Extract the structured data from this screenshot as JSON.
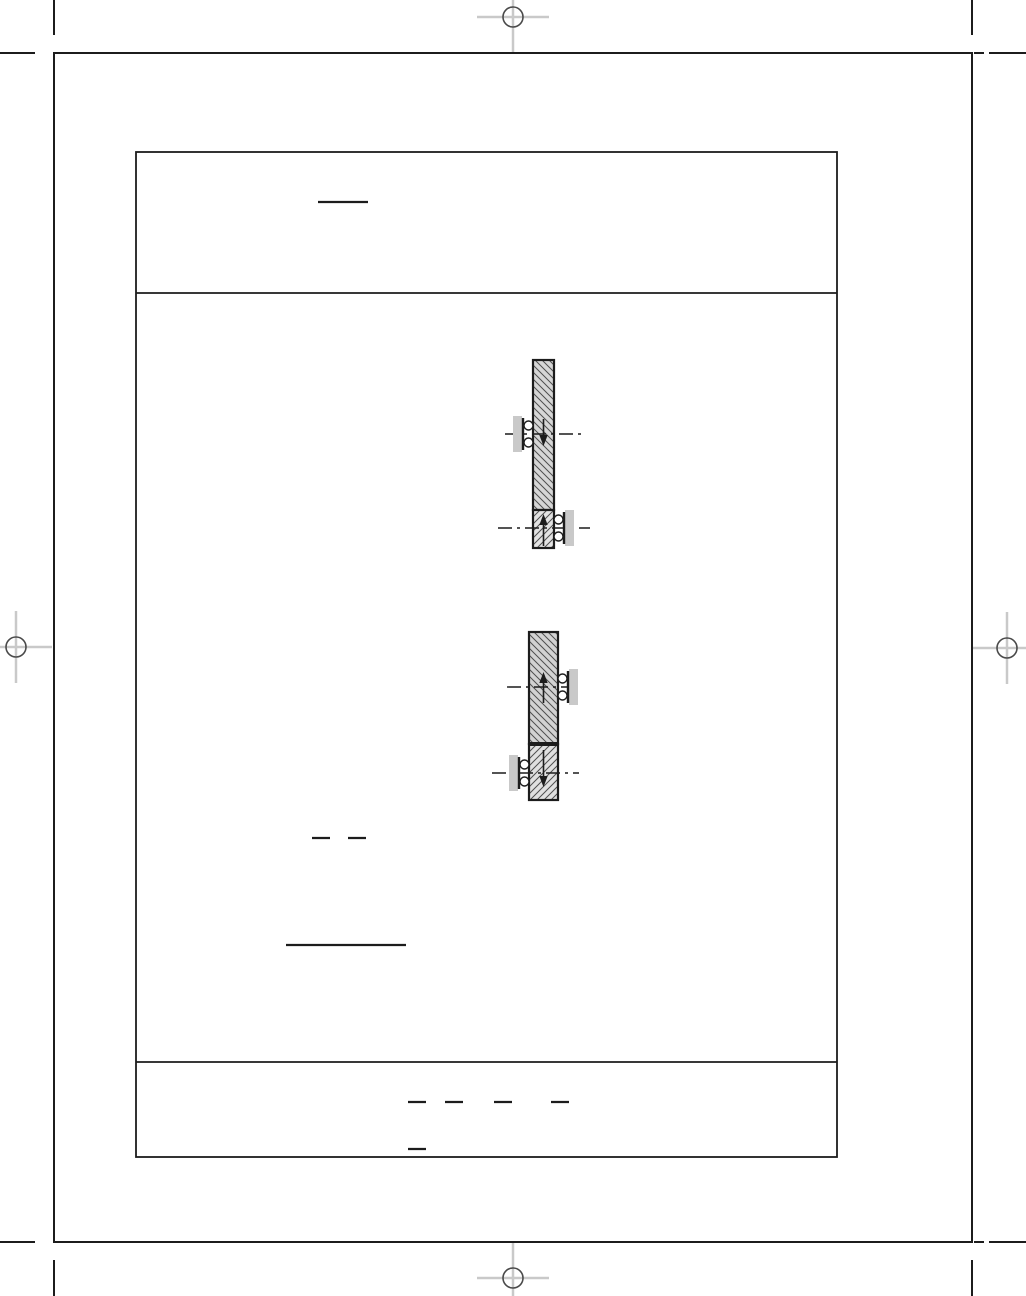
{
  "page": {
    "width": 1026,
    "height": 1296,
    "background": "#ffffff"
  },
  "colors": {
    "line": "#1c1c1c",
    "registration_cross": "#c9c9c9",
    "registration_circle": "#4a4a4a",
    "plate_fill": "#c9c9c9",
    "hatch_line": "#4f4f4f",
    "circle_fill": "#ffffff"
  },
  "frames": {
    "outer": {
      "x": 54,
      "y": 53,
      "w": 918,
      "h": 1189,
      "stroke_w": 2
    },
    "inner": {
      "x": 136,
      "y": 152,
      "w": 701,
      "h": 1005,
      "stroke_w": 1.8
    },
    "divider_y": [
      293,
      1062
    ]
  },
  "registration_marks": [
    {
      "cx": 513,
      "cy": 17,
      "r": 10,
      "arm": 36
    },
    {
      "cx": 16,
      "cy": 647,
      "r": 10,
      "arm": 36
    },
    {
      "cx": 1007,
      "cy": 648,
      "r": 10,
      "arm": 36
    },
    {
      "cx": 513,
      "cy": 1278,
      "r": 10,
      "arm": 36
    }
  ],
  "crop_marks": [
    {
      "x1": 54,
      "y1": 0,
      "x2": 54,
      "y2": 35
    },
    {
      "x1": 0,
      "y1": 53,
      "x2": 35,
      "y2": 53
    },
    {
      "x1": 972,
      "y1": 0,
      "x2": 972,
      "y2": 35
    },
    {
      "x1": 974,
      "y1": 53,
      "x2": 984,
      "y2": 53
    },
    {
      "x1": 989,
      "y1": 53,
      "x2": 1026,
      "y2": 53
    },
    {
      "x1": 54,
      "y1": 1260,
      "x2": 54,
      "y2": 1296
    },
    {
      "x1": 0,
      "y1": 1242,
      "x2": 35,
      "y2": 1242
    },
    {
      "x1": 972,
      "y1": 1260,
      "x2": 972,
      "y2": 1296
    },
    {
      "x1": 974,
      "y1": 1242,
      "x2": 984,
      "y2": 1242
    },
    {
      "x1": 989,
      "y1": 1242,
      "x2": 1026,
      "y2": 1242
    }
  ],
  "rule_lines": [
    {
      "x1": 318,
      "y": 202,
      "x2": 368
    },
    {
      "x1": 312,
      "y": 838,
      "x2": 330
    },
    {
      "x1": 348,
      "y": 838,
      "x2": 366
    },
    {
      "x1": 286,
      "y": 945,
      "x2": 406
    },
    {
      "x1": 408,
      "y": 1102,
      "x2": 426
    },
    {
      "x1": 445,
      "y": 1102,
      "x2": 463
    },
    {
      "x1": 494,
      "y": 1102,
      "x2": 512
    },
    {
      "x1": 551,
      "y": 1102,
      "x2": 569
    },
    {
      "x1": 408,
      "y": 1149,
      "x2": 426
    }
  ],
  "figures": [
    {
      "name": "support-diagram-upper",
      "bar": {
        "x": 533,
        "width": 21,
        "top": 360,
        "junction": 510,
        "bottom": 548
      },
      "junction_stroke": 1.6,
      "top_fill": "#d6d6d6",
      "bottom_fill": "#e3e3e3",
      "bearings": [
        {
          "side": "left",
          "cy": 434,
          "centerline": [
            505,
            584
          ],
          "arrow": {
            "dir": "down",
            "from": 419,
            "to": 446
          }
        },
        {
          "side": "right",
          "cy": 528,
          "centerline": [
            498,
            590
          ],
          "arrow": {
            "dir": "up",
            "from": 546,
            "to": 514
          }
        }
      ]
    },
    {
      "name": "support-diagram-lower",
      "bar": {
        "x": 529,
        "width": 29,
        "top": 632,
        "junction": 744,
        "bottom": 800
      },
      "junction_stroke": 4,
      "top_fill": "#d2d2d2",
      "bottom_fill": "#e0e0e0",
      "bearings": [
        {
          "side": "right",
          "cy": 687,
          "centerline": [
            507,
            577
          ],
          "arrow": {
            "dir": "up",
            "from": 703,
            "to": 672
          }
        },
        {
          "side": "left",
          "cy": 773,
          "centerline": [
            492,
            579
          ],
          "arrow": {
            "dir": "down",
            "from": 750,
            "to": 787
          }
        }
      ]
    }
  ]
}
